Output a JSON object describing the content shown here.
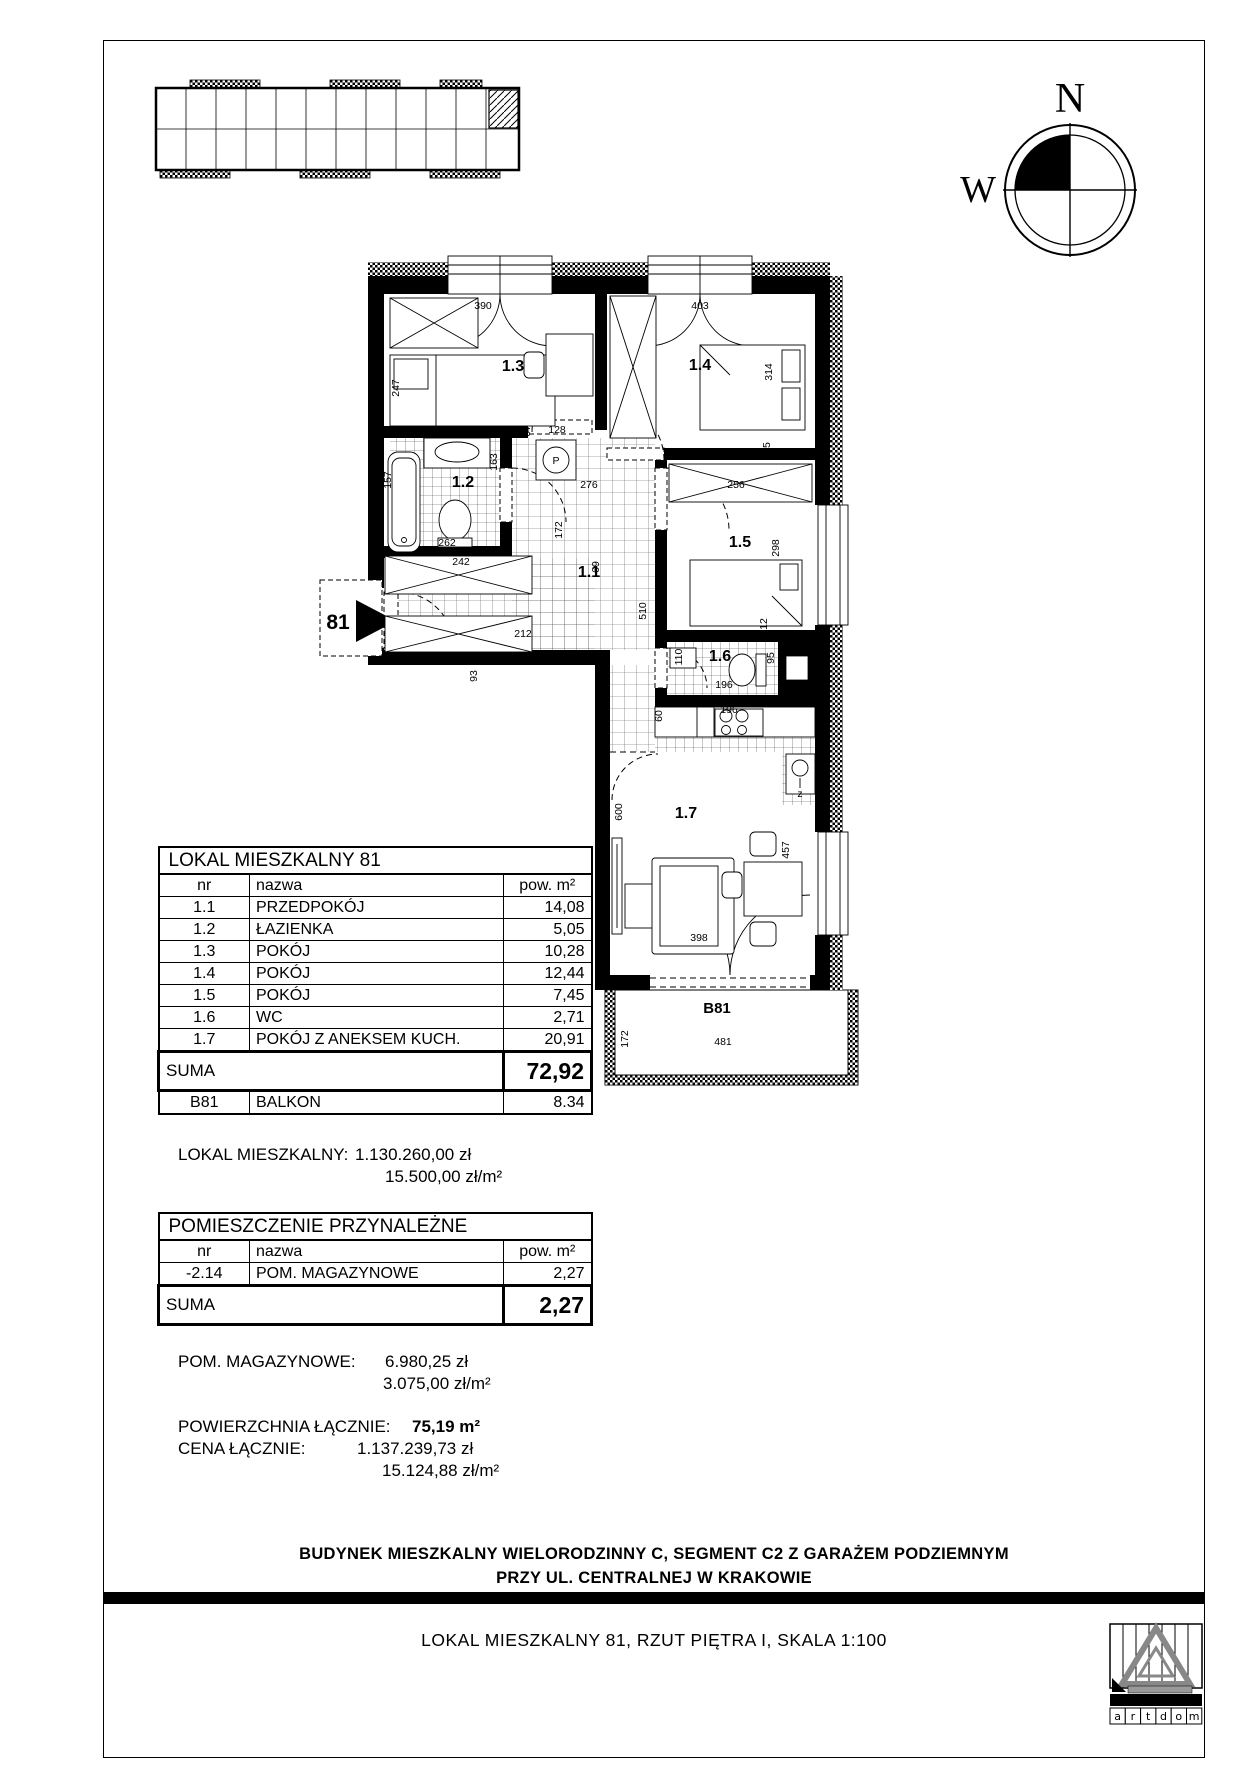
{
  "footer": {
    "line1": "BUDYNEK MIESZKALNY WIELORODZINNY C, SEGMENT C2 Z GARAŻEM PODZIEMNYM",
    "line2": "PRZY UL. CENTRALNEJ W KRAKOWIE"
  },
  "titlebar": {
    "text": "LOKAL MIESZKALNY 81, RZUT PIĘTRA I, SKALA 1:100"
  },
  "compass": {
    "north_label": "N",
    "west_label": "W"
  },
  "logo": {
    "letters": [
      "a",
      "r",
      "t",
      "d",
      "o",
      "m"
    ]
  },
  "lokal_table": {
    "title": "LOKAL MIESZKALNY 81",
    "headers": {
      "nr": "nr",
      "nazwa": "nazwa",
      "pow": "pow. m²"
    },
    "rows": [
      {
        "nr": "1.1",
        "nazwa": "PRZEDPOKÓJ",
        "pow": "14,08"
      },
      {
        "nr": "1.2",
        "nazwa": "ŁAZIENKA",
        "pow": "5,05"
      },
      {
        "nr": "1.3",
        "nazwa": "POKÓJ",
        "pow": "10,28"
      },
      {
        "nr": "1.4",
        "nazwa": "POKÓJ",
        "pow": "12,44"
      },
      {
        "nr": "1.5",
        "nazwa": "POKÓJ",
        "pow": "7,45"
      },
      {
        "nr": "1.6",
        "nazwa": "WC",
        "pow": "2,71"
      },
      {
        "nr": "1.7",
        "nazwa": "POKÓJ Z ANEKSEM KUCH.",
        "pow": "20,91"
      }
    ],
    "suma_label": "SUMA",
    "suma_value": "72,92",
    "balkon_row": {
      "nr": "B81",
      "nazwa": "BALKON",
      "pow": "8.34"
    }
  },
  "prices": {
    "lokal": {
      "label": "LOKAL MIESZKALNY:",
      "price": "1.130.260,00 zł",
      "price_m2": "15.500,00 zł/m²"
    },
    "storage": {
      "label": "POM. MAGAZYNOWE:",
      "price": "6.980,25 zł",
      "price_m2": "3.075,00 zł/m²"
    }
  },
  "przynalezne_table": {
    "title": "POMIESZCZENIE PRZYNALEŻNE",
    "headers": {
      "nr": "nr",
      "nazwa": "nazwa",
      "pow": "pow. m²"
    },
    "rows": [
      {
        "nr": "-2.14",
        "nazwa": "POM. MAGAZYNOWE",
        "pow": "2,27"
      }
    ],
    "suma_label": "SUMA",
    "suma_value": "2,27"
  },
  "totals": {
    "area_label": "POWIERZCHNIA ŁĄCZNIE:",
    "area_value": "75,19 m²",
    "price_label": "CENA ŁĄCZNIE:",
    "price_value": "1.137.239,73 zł",
    "price_m2": "15.124,88 zł/m²"
  },
  "plan": {
    "unit_number": "81",
    "balcony_label": "B81",
    "rooms": [
      {
        "id": "1.1",
        "x": 589,
        "y": 577
      },
      {
        "id": "1.2",
        "x": 463,
        "y": 487
      },
      {
        "id": "1.3",
        "x": 513,
        "y": 371
      },
      {
        "id": "1.4",
        "x": 700,
        "y": 370
      },
      {
        "id": "1.5",
        "x": 740,
        "y": 547
      },
      {
        "id": "1.6",
        "x": 720,
        "y": 661
      },
      {
        "id": "1.7",
        "x": 686,
        "y": 818
      }
    ],
    "dims": [
      {
        "t": "390",
        "x": 483,
        "y": 309
      },
      {
        "t": "12",
        "x": 601,
        "y": 309
      },
      {
        "t": "403",
        "x": 700,
        "y": 309
      },
      {
        "t": "247",
        "x": 399,
        "y": 388,
        "v": 1
      },
      {
        "t": "314",
        "x": 772,
        "y": 372,
        "v": 1
      },
      {
        "t": "25",
        "x": 770,
        "y": 448,
        "v": 1
      },
      {
        "t": "67",
        "x": 530,
        "y": 431,
        "v": 1
      },
      {
        "t": "128",
        "x": 557,
        "y": 433
      },
      {
        "t": "163",
        "x": 497,
        "y": 462,
        "v": 1
      },
      {
        "t": "250",
        "x": 446,
        "y": 435
      },
      {
        "t": "157",
        "x": 391,
        "y": 480,
        "v": 1
      },
      {
        "t": "262",
        "x": 447,
        "y": 546
      },
      {
        "t": "172",
        "x": 562,
        "y": 530,
        "v": 1
      },
      {
        "t": "276",
        "x": 589,
        "y": 488
      },
      {
        "t": "256",
        "x": 736,
        "y": 488
      },
      {
        "t": "298",
        "x": 779,
        "y": 548,
        "v": 1
      },
      {
        "t": "510",
        "x": 646,
        "y": 611,
        "v": 1
      },
      {
        "t": "69",
        "x": 599,
        "y": 567,
        "v": 1
      },
      {
        "t": "242",
        "x": 461,
        "y": 565
      },
      {
        "t": "212",
        "x": 523,
        "y": 637
      },
      {
        "t": "358",
        "x": 505,
        "y": 661
      },
      {
        "t": "93",
        "x": 477,
        "y": 676,
        "v": 1
      },
      {
        "t": "110",
        "x": 682,
        "y": 657,
        "v": 1
      },
      {
        "t": "95",
        "x": 774,
        "y": 658,
        "v": 1
      },
      {
        "t": "12",
        "x": 767,
        "y": 624,
        "v": 1
      },
      {
        "t": "196",
        "x": 724,
        "y": 688
      },
      {
        "t": "60",
        "x": 662,
        "y": 716,
        "v": 1
      },
      {
        "t": "196",
        "x": 729,
        "y": 713
      },
      {
        "t": "600",
        "x": 622,
        "y": 812,
        "v": 1
      },
      {
        "t": "457",
        "x": 789,
        "y": 850,
        "v": 1
      },
      {
        "t": "398",
        "x": 699,
        "y": 941
      },
      {
        "t": "172",
        "x": 628,
        "y": 1039,
        "v": 1
      },
      {
        "t": "481",
        "x": 723,
        "y": 1045
      },
      {
        "t": "z",
        "x": 800,
        "y": 797
      }
    ]
  }
}
